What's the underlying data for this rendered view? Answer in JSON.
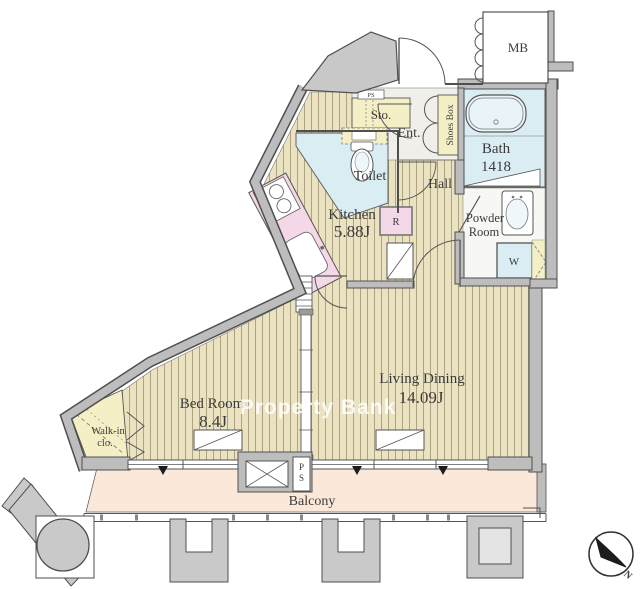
{
  "plan": {
    "watermark": "Property Bank",
    "compass_north": "N",
    "rooms": {
      "living_dining": {
        "name": "Living Dining",
        "size": "14.09J"
      },
      "bed_room": {
        "name": "Bed Room",
        "size": "8.4J"
      },
      "kitchen": {
        "name": "Kitchen",
        "size": "5.88J"
      },
      "bath": {
        "name": "Bath",
        "size": "1418"
      },
      "powder_room": {
        "line1": "Powder",
        "line2": "Room"
      },
      "toilet": "Toilet",
      "hall": "Hall",
      "entrance": "Ent.",
      "storage": "Sto.",
      "shoes_box": "Shoes Box",
      "walk_in_closet": {
        "line1": "Walk-in",
        "line2": "clo."
      },
      "balcony": "Balcony",
      "meter_box": "MB"
    },
    "fixtures": {
      "washing_machine": "W",
      "refrigerator": "R",
      "pipe_space_upper": "PS",
      "pipe_space_lower": {
        "line1": "P",
        "line2": "S"
      }
    },
    "colors": {
      "flooring": "#EBE2C2",
      "flooring_stripe": "#A59C78",
      "wet_area_blue": "#D9EDF3",
      "kitchen_counter_pink": "#F5D8E8",
      "storage_yellow": "#F5EFC6",
      "balcony_floor": "#FBE8D9",
      "wall_fill": "#BDBDBD",
      "wall_edge": "#4F4F4F",
      "entrance_floor": "#F0EFEA"
    }
  }
}
